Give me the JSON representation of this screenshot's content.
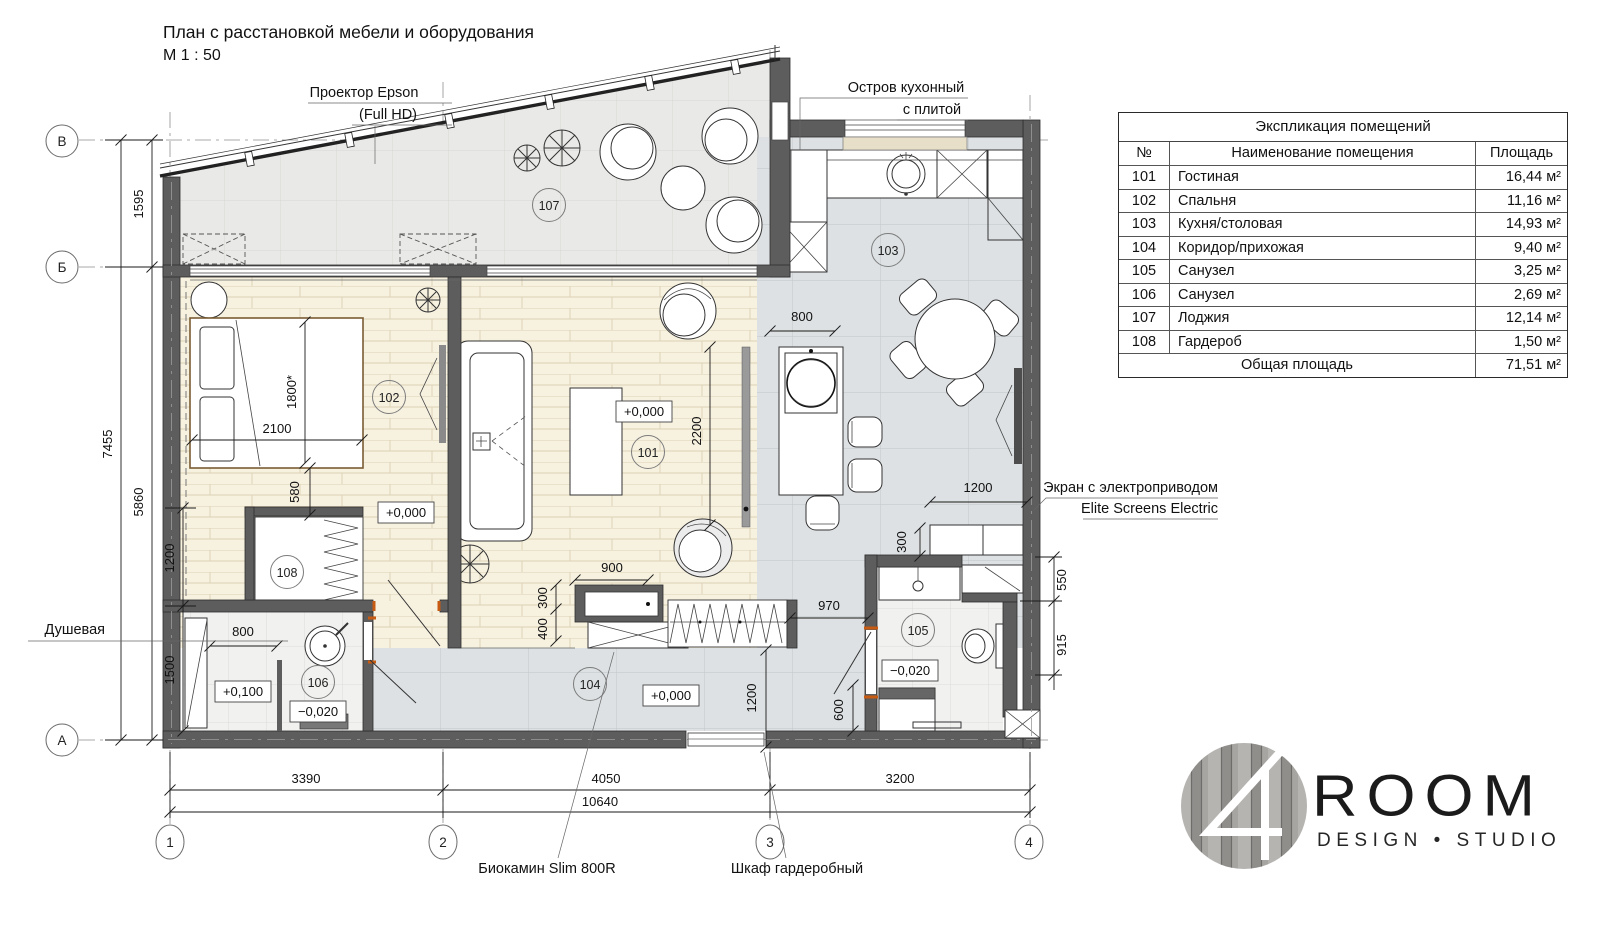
{
  "title": {
    "line1": "План с расстановкой мебели и оборудования",
    "line2": "М 1 : 50"
  },
  "annotations": {
    "projector_line1": "Проектор Epson",
    "projector_line2": "(Full HD)",
    "island_line1": "Остров кухонный",
    "island_line2": "с плитой",
    "screen_line1": "Экран с электроприводом",
    "screen_line2": "Elite Screens Electric",
    "shower_label": "Душевая",
    "fireplace_label": "Биокамин Slim 800R",
    "wardrobe_label": "Шкаф гардеробный"
  },
  "axes": {
    "row_b": "В",
    "row_mid": "Б",
    "row_a": "А",
    "col_1": "1",
    "col_2": "2",
    "col_3": "3",
    "col_4": "4"
  },
  "dims": {
    "left_1595": "1595",
    "left_7455": "7455",
    "left_5860": "5860",
    "left_1200": "1200",
    "left_1500": "1500",
    "bottom_3390": "3390",
    "bottom_4050": "4050",
    "bottom_3200": "3200",
    "bottom_10640": "10640",
    "bed_2100": "2100",
    "bed_1800": "1800*",
    "bed_580": "580",
    "living_2200": "2200",
    "living_900": "900",
    "living_300": "300",
    "living_400": "400",
    "living_970": "970",
    "kitchen_800": "800",
    "kitchen_1200": "1200",
    "corridor_1200": "1200",
    "shower_800": "800",
    "bath_300": "300",
    "bath_550": "550",
    "bath_915": "915",
    "bath_600": "600"
  },
  "levels": {
    "bedroom": "+0,000",
    "living": "+0,000",
    "corridor": "+0,000",
    "shower_tray": "+0,100",
    "shower": "−0,020",
    "bath": "−0,020"
  },
  "rooms": {
    "r101": "101",
    "r102": "102",
    "r103": "103",
    "r104": "104",
    "r105": "105",
    "r106": "106",
    "r107": "107",
    "r108": "108"
  },
  "table": {
    "title": "Экспликация помещений",
    "columns": {
      "no": "№",
      "name": "Наименование помещения",
      "area": "Площадь"
    },
    "rows": [
      {
        "no": "101",
        "name": "Гостиная",
        "area": "16,44 м²"
      },
      {
        "no": "102",
        "name": "Спальня",
        "area": "11,16 м²"
      },
      {
        "no": "103",
        "name": "Кухня/столовая",
        "area": "14,93 м²"
      },
      {
        "no": "104",
        "name": "Коридор/прихожая",
        "area": "9,40 м²"
      },
      {
        "no": "105",
        "name": "Санузел",
        "area": "3,25 м²"
      },
      {
        "no": "106",
        "name": "Санузел",
        "area": "2,69 м²"
      },
      {
        "no": "107",
        "name": "Лоджия",
        "area": "12,14 м²"
      },
      {
        "no": "108",
        "name": "Гардероб",
        "area": "1,50 м²"
      }
    ],
    "total_label": "Общая площадь",
    "total_value": "71,51 м²"
  },
  "logo": {
    "numeral": "4",
    "name": "ROOM",
    "subtitle": "DESIGN • STUDIO"
  }
}
